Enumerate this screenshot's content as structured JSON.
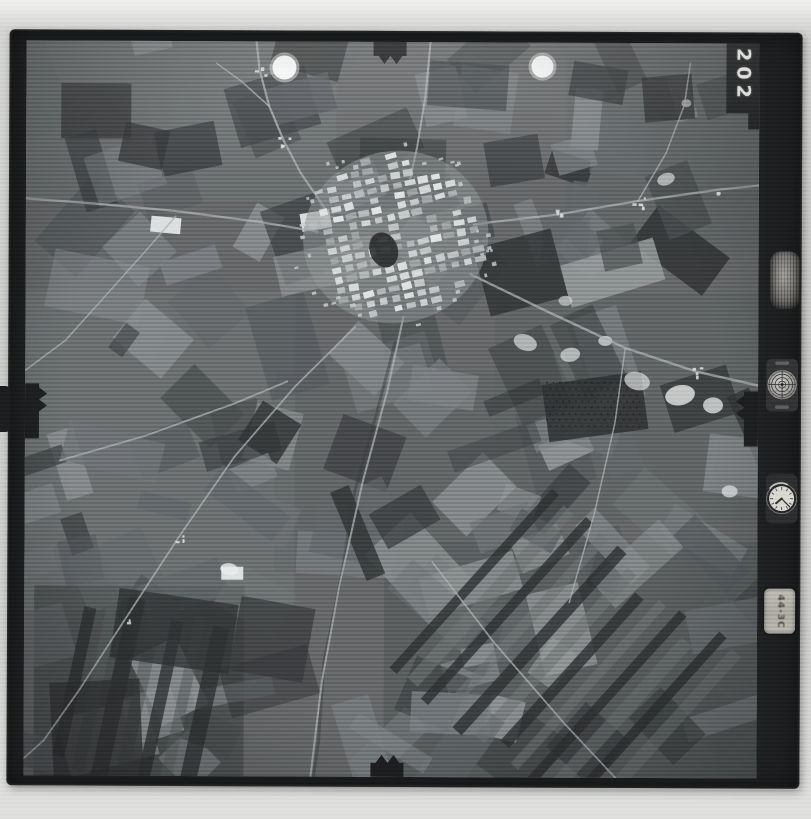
{
  "scan": {
    "background_color": "#c9c9c8",
    "film_color": "#1e1f20",
    "photo_base_color": "#626465"
  },
  "frame_number": "202",
  "instrument_panel": {
    "altimeter": {
      "icon": "altimeter-drum-icon"
    },
    "level": {
      "icon": "bubble-level-icon"
    },
    "clock": {
      "icon": "clock-icon",
      "hour_angle": 230,
      "minute_angle": 135
    },
    "data_plate": {
      "text": "44-3C"
    }
  },
  "photo": {
    "width": 733,
    "height": 735,
    "seed": 7,
    "palette": [
      "#2f3233",
      "#3b3e40",
      "#474b4c",
      "#53575a",
      "#5f6467",
      "#6b7072",
      "#787d80",
      "#868b8d",
      "#94989a"
    ],
    "field_count": 150,
    "field_orientations": [
      -18,
      -18,
      42,
      70,
      8,
      -48,
      25
    ],
    "regions": [
      {
        "x": 0,
        "y": 0,
        "w": 310,
        "h": 160,
        "fill": "#6d7173",
        "o": 0.45
      },
      {
        "x": 0,
        "y": 250,
        "w": 270,
        "h": 320,
        "fill": "#74787a",
        "o": 0.35
      },
      {
        "x": 10,
        "y": 545,
        "w": 210,
        "h": 190,
        "fill": "#3c3f40",
        "o": 0.55
      },
      {
        "x": 360,
        "y": 500,
        "w": 373,
        "h": 235,
        "fill": "#4b4f51",
        "o": 0.45
      },
      {
        "x": 470,
        "y": 250,
        "w": 263,
        "h": 230,
        "fill": "#565b5d",
        "o": 0.35
      },
      {
        "x": 540,
        "y": 10,
        "w": 193,
        "h": 200,
        "fill": "#595e60",
        "o": 0.35
      },
      {
        "x": 250,
        "y": 330,
        "w": 230,
        "h": 200,
        "fill": "#5a5f61",
        "o": 0.3
      }
    ],
    "dark_patches": [
      {
        "cx": 570,
        "cy": 364,
        "w": 100,
        "h": 58,
        "rot": -8,
        "fill": "#2d2f30",
        "o": 0.85
      },
      {
        "cx": 70,
        "cy": 70,
        "w": 70,
        "h": 55,
        "rot": 0,
        "fill": "#333536",
        "o": 0.8
      },
      {
        "cx": 118,
        "cy": 105,
        "w": 45,
        "h": 40,
        "rot": 12,
        "fill": "#303233",
        "o": 0.75
      },
      {
        "cx": 495,
        "cy": 230,
        "w": 80,
        "h": 70,
        "rot": -15,
        "fill": "#2e3132",
        "o": 0.8
      },
      {
        "cx": 572,
        "cy": 40,
        "w": 55,
        "h": 35,
        "rot": 10,
        "fill": "#323435",
        "o": 0.75
      },
      {
        "cx": 642,
        "cy": 55,
        "w": 50,
        "h": 45,
        "rot": -5,
        "fill": "#2c2e2f",
        "o": 0.8
      },
      {
        "cx": 150,
        "cy": 590,
        "w": 120,
        "h": 70,
        "rot": 8,
        "fill": "#2e3031",
        "o": 0.75
      },
      {
        "cx": 73,
        "cy": 690,
        "w": 90,
        "h": 100,
        "rot": -3,
        "fill": "#303233",
        "o": 0.75
      },
      {
        "cx": 248,
        "cy": 598,
        "w": 75,
        "h": 75,
        "rot": 10,
        "fill": "#343637",
        "o": 0.7
      },
      {
        "cx": 380,
        "cy": 475,
        "w": 60,
        "h": 40,
        "rot": -30,
        "fill": "#35383a",
        "o": 0.7
      },
      {
        "cx": 488,
        "cy": 118,
        "w": 55,
        "h": 45,
        "rot": -10,
        "fill": "#35383a",
        "o": 0.7
      }
    ],
    "strip_groups": [
      {
        "cx": 540,
        "cy": 620,
        "angle": -48,
        "count": 12,
        "len": 230,
        "w": 11,
        "gap": 11,
        "fillA": "#2d3031",
        "oA": 0.8,
        "fillB": "#6a6f70",
        "oB": 0.6
      },
      {
        "cx": 115,
        "cy": 655,
        "angle": -78,
        "count": 7,
        "len": 170,
        "w": 13,
        "gap": 9,
        "fillA": "#2b2d2e",
        "oA": 0.75,
        "fillB": "#585c5d",
        "oB": 0.55
      }
    ],
    "orchard": {
      "x": 522,
      "y": 340,
      "cols": 15,
      "rows": 8,
      "dx": 6.4,
      "dy": 6.2,
      "r": 0.9,
      "fill": "#1e2021",
      "o": 0.8
    },
    "bright_spots": [
      {
        "cx": 500,
        "cy": 300,
        "rx": 12,
        "ry": 8,
        "rot": 20,
        "o": 0.7
      },
      {
        "cx": 545,
        "cy": 312,
        "rx": 10,
        "ry": 7,
        "rot": -10,
        "o": 0.7
      },
      {
        "cx": 580,
        "cy": 298,
        "rx": 7,
        "ry": 5,
        "rot": 0,
        "o": 0.75
      },
      {
        "cx": 612,
        "cy": 338,
        "rx": 13,
        "ry": 9,
        "rot": 15,
        "o": 0.7
      },
      {
        "cx": 655,
        "cy": 352,
        "rx": 15,
        "ry": 10,
        "rot": -12,
        "o": 0.85
      },
      {
        "cx": 688,
        "cy": 362,
        "rx": 10,
        "ry": 8,
        "rot": 0,
        "o": 0.8
      },
      {
        "cx": 205,
        "cy": 528,
        "rx": 9,
        "ry": 6,
        "rot": 8,
        "o": 0.9
      },
      {
        "cx": 705,
        "cy": 448,
        "rx": 8,
        "ry": 6,
        "rot": 0,
        "o": 0.8
      },
      {
        "cx": 640,
        "cy": 136,
        "rx": 9,
        "ry": 6,
        "rot": -20,
        "o": 0.7
      },
      {
        "cx": 540,
        "cy": 258,
        "rx": 7,
        "ry": 5,
        "rot": 0,
        "o": 0.6
      },
      {
        "cx": 660,
        "cy": 60,
        "rx": 5,
        "ry": 4,
        "rot": 0,
        "o": 0.6
      }
    ],
    "white_patches": [
      {
        "cx": 290,
        "cy": 179,
        "w": 30,
        "h": 18,
        "rot": -10
      },
      {
        "cx": 140,
        "cy": 184,
        "w": 30,
        "h": 16,
        "rot": 5
      },
      {
        "cx": 208,
        "cy": 532,
        "w": 22,
        "h": 13,
        "rot": 0
      }
    ],
    "stream": {
      "pts": [
        [
          370,
          300
        ],
        [
          352,
          370
        ],
        [
          330,
          450
        ],
        [
          318,
          530
        ],
        [
          300,
          620
        ],
        [
          295,
          700
        ],
        [
          290,
          735
        ]
      ],
      "stroke": "#383a3a",
      "w": 3,
      "o": 0.45
    },
    "roads": [
      {
        "pts": [
          [
            0,
            158
          ],
          [
            70,
            163
          ],
          [
            150,
            170
          ],
          [
            230,
            180
          ],
          [
            292,
            190
          ]
        ],
        "w": 2.2
      },
      {
        "pts": [
          [
            300,
            168
          ],
          [
            275,
            132
          ],
          [
            258,
            100
          ],
          [
            243,
            65
          ],
          [
            233,
            28
          ],
          [
            230,
            0
          ]
        ],
        "w": 2.2
      },
      {
        "pts": [
          [
            243,
            65
          ],
          [
            215,
            40
          ],
          [
            190,
            22
          ]
        ],
        "w": 1.5
      },
      {
        "pts": [
          [
            448,
            182
          ],
          [
            530,
            172
          ],
          [
            612,
            158
          ],
          [
            695,
            146
          ],
          [
            733,
            142
          ]
        ],
        "w": 2.2
      },
      {
        "pts": [
          [
            445,
            232
          ],
          [
            520,
            268
          ],
          [
            600,
            305
          ],
          [
            670,
            328
          ],
          [
            733,
            342
          ]
        ],
        "w": 2.4
      },
      {
        "pts": [
          [
            378,
            275
          ],
          [
            362,
            350
          ],
          [
            338,
            440
          ],
          [
            315,
            545
          ],
          [
            298,
            640
          ],
          [
            287,
            735
          ]
        ],
        "w": 2
      },
      {
        "pts": [
          [
            404,
            0
          ],
          [
            399,
            55
          ],
          [
            391,
            105
          ],
          [
            383,
            142
          ]
        ],
        "w": 2
      },
      {
        "pts": [
          [
            408,
            520
          ],
          [
            470,
            600
          ],
          [
            540,
            680
          ],
          [
            592,
            735
          ]
        ],
        "w": 1.8
      },
      {
        "pts": [
          [
            330,
            285
          ],
          [
            270,
            345
          ],
          [
            210,
            415
          ],
          [
            155,
            495
          ],
          [
            100,
            580
          ],
          [
            55,
            650
          ],
          [
            20,
            700
          ],
          [
            0,
            718
          ]
        ],
        "w": 1.8
      },
      {
        "pts": [
          [
            35,
            420
          ],
          [
            120,
            395
          ],
          [
            210,
            362
          ],
          [
            262,
            340
          ]
        ],
        "w": 1.8
      },
      {
        "pts": [
          [
            150,
            175
          ],
          [
            120,
            210
          ],
          [
            80,
            255
          ],
          [
            40,
            300
          ],
          [
            0,
            330
          ]
        ],
        "w": 1.5
      },
      {
        "pts": [
          [
            600,
            305
          ],
          [
            590,
            380
          ],
          [
            570,
            470
          ],
          [
            545,
            560
          ]
        ],
        "w": 1.5
      },
      {
        "pts": [
          [
            612,
            158
          ],
          [
            640,
            110
          ],
          [
            658,
            62
          ],
          [
            664,
            20
          ]
        ],
        "w": 1.5
      }
    ],
    "settlements": [
      {
        "x": 258,
        "y": 100,
        "n": 4
      },
      {
        "x": 233,
        "y": 28,
        "n": 3
      },
      {
        "x": 530,
        "y": 172,
        "n": 3
      },
      {
        "x": 612,
        "y": 158,
        "n": 4
      },
      {
        "x": 695,
        "y": 146,
        "n": 3
      },
      {
        "x": 155,
        "y": 495,
        "n": 3
      },
      {
        "x": 670,
        "y": 328,
        "n": 4
      },
      {
        "x": 100,
        "y": 580,
        "n": 2
      }
    ],
    "town": {
      "cx": 370,
      "cy": 195,
      "rx": 85,
      "ry": 80,
      "angle": -13,
      "block_shades": [
        "#b4b8b9",
        "#c6cacb",
        "#d4d7d7",
        "#9fa3a5",
        "#e2e4e4"
      ],
      "dark_blob": {
        "cx": 358,
        "cy": 208,
        "rx": 14,
        "ry": 18,
        "rot": -20,
        "fill": "#2a2c2c"
      },
      "scatter": 40
    },
    "flares": [
      {
        "cx": 258,
        "cy": 26,
        "r": 12
      },
      {
        "cx": 516,
        "cy": 24,
        "r": 11
      }
    ],
    "fiducials": [
      "347,0 380,0 380,14 376,14 370,22 364,14 358,22 352,14 347,14",
      "347,735 380,735 380,721 376,721 370,713 364,721 358,713 352,721 347,721",
      "0,343 14,343 14,347 22,353 14,359 22,365 14,371 14,398 0,398",
      "733,348 719,348 719,352 711,358 719,364 711,370 719,376 719,403 733,403",
      "700,0 733,0 733,86 722,86 722,70 700,70"
    ]
  }
}
